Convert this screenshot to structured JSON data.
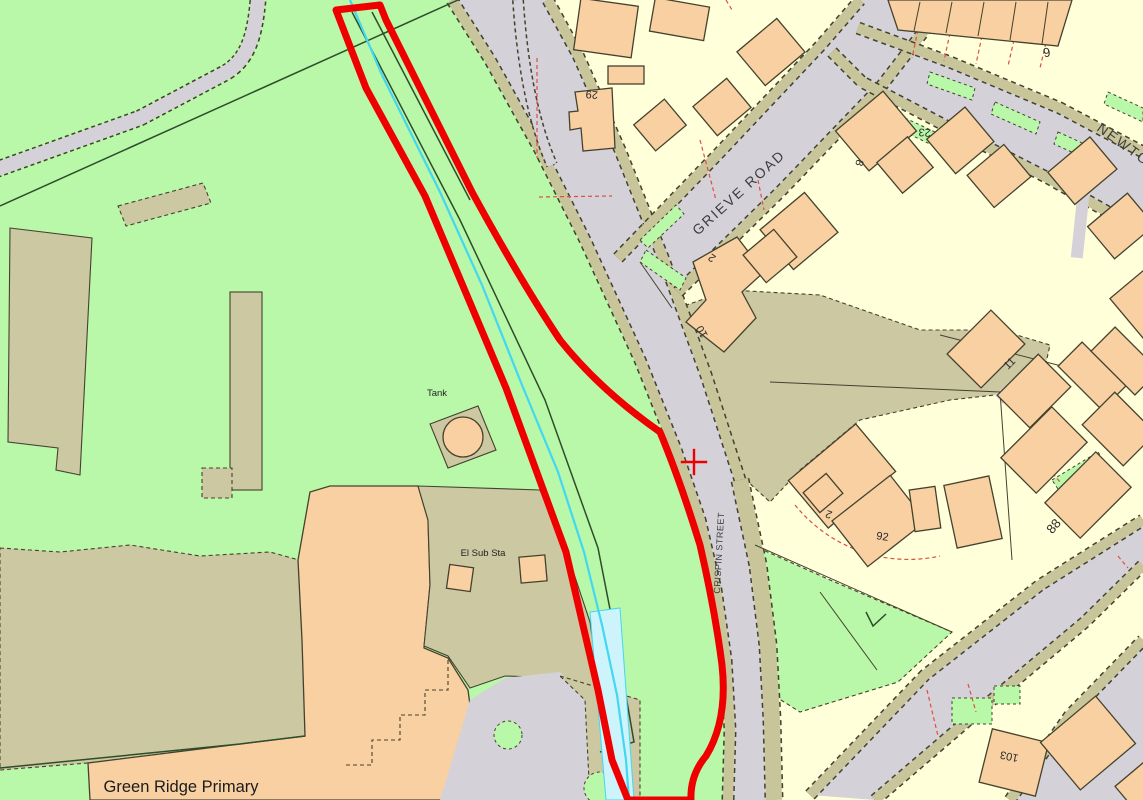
{
  "map": {
    "labels": {
      "grieve_road": "GRIEVE ROAD",
      "newton_road": "NEWTON",
      "crispin_street": "CRISPIN STREET",
      "tank": "Tank",
      "el_sub_sta": "El Sub Sta",
      "school": "Green Ridge Primary"
    },
    "house_numbers": {
      "n6": "6",
      "n23": "23",
      "n29": "29",
      "n8": "8",
      "n2_grieve": "2",
      "n10": "10",
      "n92": "92",
      "n2_south": "2",
      "n88": "88",
      "n11": "11",
      "n103": "103"
    },
    "marker": {
      "type": "crosshair",
      "color": "#ee0000"
    },
    "colors": {
      "field_green": "#b9f7a9",
      "parcel_yellow": "#ffffd9",
      "grounds_khaki": "#ccc8a2",
      "verge_khaki": "#c9c59b",
      "road_gray": "#d4d2d8",
      "building_orange": "#f8d0a2",
      "outline_dark": "#44422e",
      "boundary_red": "#ee0000",
      "stream_cyan": "#43d7f2",
      "stream_fill": "#cdf3fb",
      "lot_line_red": "#e04e3f",
      "field_line_green": "#2e4d2a",
      "label_dark": "#2a2a2a"
    }
  }
}
